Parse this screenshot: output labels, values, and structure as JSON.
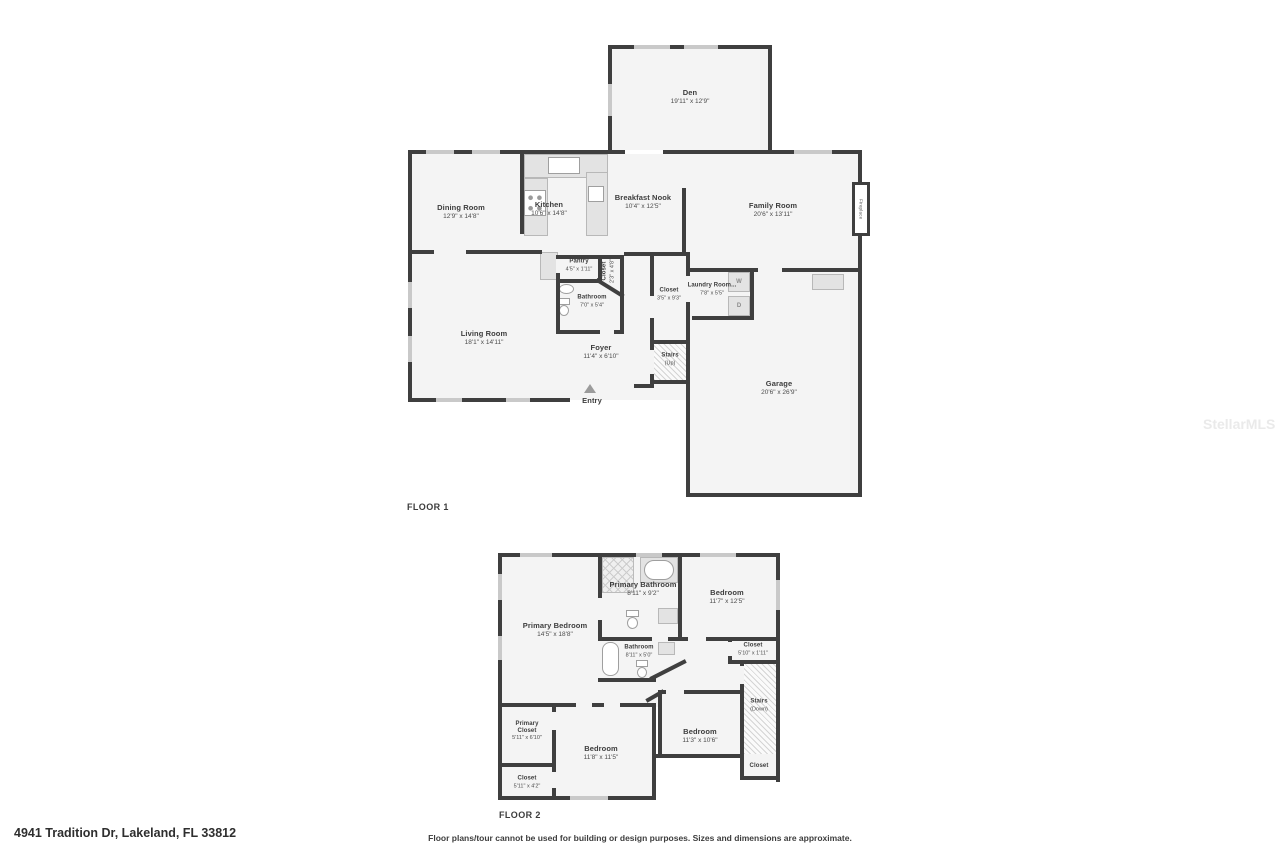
{
  "watermark": "StellarMLS",
  "footer": {
    "address": "4941 Tradition Dr, Lakeland, FL 33812",
    "disclaimer": "Floor plans/tour cannot be used for building or design purposes. Sizes and dimensions are approximate."
  },
  "floor1": {
    "label": "FLOOR 1",
    "rooms": {
      "den": {
        "name": "Den",
        "dims": "19'11\" x 12'9\""
      },
      "dining_room": {
        "name": "Dining Room",
        "dims": "12'9\" x 14'8\""
      },
      "kitchen": {
        "name": "Kitchen",
        "dims": "10'6\" x 14'8\""
      },
      "breakfast_nook": {
        "name": "Breakfast Nook",
        "dims": "10'4\" x 12'5\""
      },
      "family_room": {
        "name": "Family Room",
        "dims": "20'6\" x 13'11\""
      },
      "fireplace": {
        "name": "Fireplace"
      },
      "pantry": {
        "name": "Pantry",
        "dims": "4'5\" x 1'11\""
      },
      "kitchen_closet": {
        "name": "Closet",
        "dims": "2'3\" x 4'8\""
      },
      "bathroom": {
        "name": "Bathroom",
        "dims": "7'0\" x 5'4\""
      },
      "hall_closet": {
        "name": "Closet",
        "dims": "3'5\" x 9'3\""
      },
      "laundry_room": {
        "name": "Laundry Room...",
        "dims": "7'8\" x 5'5\"",
        "washer": "W",
        "dryer": "D"
      },
      "living_room": {
        "name": "Living Room",
        "dims": "18'1\" x 14'11\""
      },
      "stairs": {
        "name": "Stairs",
        "sub": "(Up)"
      },
      "foyer": {
        "name": "Foyer",
        "dims": "11'4\" x 6'10\""
      },
      "entry": {
        "name": "Entry"
      },
      "garage": {
        "name": "Garage",
        "dims": "20'6\" x 26'9\""
      }
    }
  },
  "floor2": {
    "label": "FLOOR 2",
    "rooms": {
      "primary_bedroom": {
        "name": "Primary Bedroom",
        "dims": "14'5\" x 18'8\""
      },
      "primary_bathroom": {
        "name": "Primary Bathroom",
        "dims": "8'11\" x 9'2\""
      },
      "bedroom_right": {
        "name": "Bedroom",
        "dims": "11'7\" x 12'5\""
      },
      "closet_right": {
        "name": "Closet",
        "dims": "5'10\" x 1'11\""
      },
      "bathroom": {
        "name": "Bathroom",
        "dims": "8'11\" x 5'0\""
      },
      "stairs": {
        "name": "Stairs",
        "sub": "(Down)"
      },
      "bedroom_mid": {
        "name": "Bedroom",
        "dims": "11'3\" x 10'6\""
      },
      "closet_stairs": {
        "name": "Closet"
      },
      "primary_closet": {
        "name": "Primary Closet",
        "dims": "5'11\" x 6'10\""
      },
      "closet_left": {
        "name": "Closet",
        "dims": "5'11\" x 4'2\""
      },
      "bedroom_bottom": {
        "name": "Bedroom",
        "dims": "11'8\" x 11'5\""
      }
    }
  }
}
